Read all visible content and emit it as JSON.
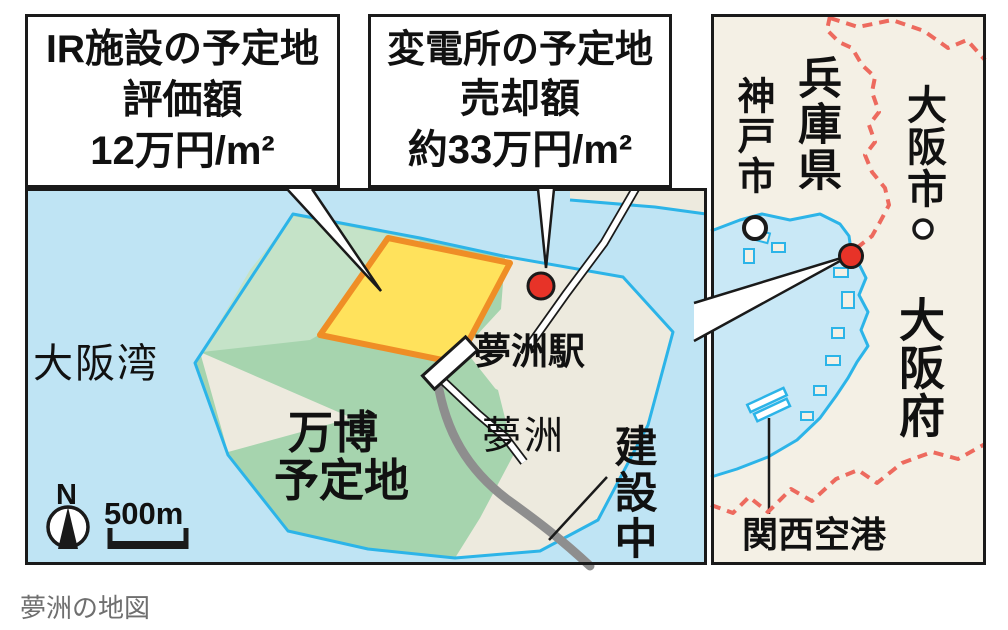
{
  "caption": "夢洲の地図",
  "detail_map": {
    "callout_ir": {
      "line1": "IR施設の予定地",
      "line2": "評価額",
      "line3": "12万円/m²"
    },
    "callout_substation": {
      "line1": "変電所の予定地",
      "line2": "売却額",
      "line3": "約33万円/m²"
    },
    "labels": {
      "bay": "大阪湾",
      "expo_line1": "万博",
      "expo_line2": "予定地",
      "station": "夢洲駅",
      "island": "夢洲",
      "under_construction": "建設中",
      "north": "N",
      "scale": "500m"
    }
  },
  "overview_map": {
    "labels": {
      "kobe_city": "神戸市",
      "hyogo_pref": "兵庫県",
      "osaka_city": "大阪市",
      "osaka_pref": "大阪府",
      "kansai_airport": "関西空港"
    }
  },
  "colors": {
    "sea": "#bfe4f4",
    "overview_sea": "#c9e8f6",
    "island_beige": "#edeade",
    "overview_land": "#f4f0e5",
    "expo_green": "#a6d4ae",
    "expo_green_light": "#c5e3c8",
    "ir_parcel_yellow": "#ffe25c",
    "ir_parcel_border": "#ef8e26",
    "coastline": "#2cb4e8",
    "prefecture_border": "#ed6a5e",
    "marker_red": "#e73328",
    "railway_gray": "#8e8e8e"
  }
}
